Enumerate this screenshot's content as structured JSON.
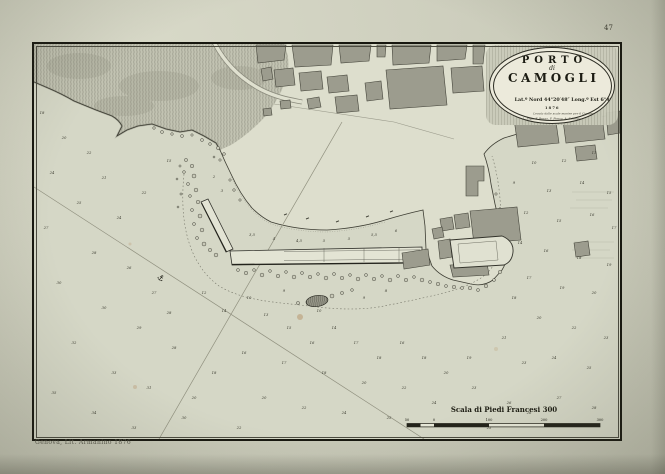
{
  "page": {
    "number": "47",
    "imprint": "Genova, Lit. Armanino 1876"
  },
  "cartouche": {
    "title_line1": "PORTO",
    "title_line2": "di",
    "title_line3": "CAMOGLI",
    "coords": "Lat.º Nord 44°20′48″ Long.º Est 6°49′5″",
    "year": "1876",
    "credit_line1": "Levata dalle scale marine per il Comune e di dettaglio di",
    "credit_line2": "L. Siga, F. Braga, F. Ponca, A. Schiavo"
  },
  "scale": {
    "title": "Scala di Piedi Francesi 300",
    "labels": [
      "50",
      "0",
      "100",
      "200",
      "300"
    ]
  },
  "map": {
    "anchor_symbol": "⚓",
    "soundings": [
      {
        "x": 8,
        "y": 70,
        "v": "18"
      },
      {
        "x": 30,
        "y": 95,
        "v": "20"
      },
      {
        "x": 55,
        "y": 110,
        "v": "22"
      },
      {
        "x": 18,
        "y": 130,
        "v": "24"
      },
      {
        "x": 70,
        "y": 135,
        "v": "21"
      },
      {
        "x": 45,
        "y": 160,
        "v": "25"
      },
      {
        "x": 12,
        "y": 185,
        "v": "27"
      },
      {
        "x": 85,
        "y": 175,
        "v": "24"
      },
      {
        "x": 110,
        "y": 150,
        "v": "22"
      },
      {
        "x": 135,
        "y": 118,
        "v": "15"
      },
      {
        "x": 60,
        "y": 210,
        "v": "28"
      },
      {
        "x": 95,
        "y": 225,
        "v": "26"
      },
      {
        "x": 25,
        "y": 240,
        "v": "30"
      },
      {
        "x": 120,
        "y": 250,
        "v": "27"
      },
      {
        "x": 70,
        "y": 265,
        "v": "30"
      },
      {
        "x": 105,
        "y": 285,
        "v": "29"
      },
      {
        "x": 40,
        "y": 300,
        "v": "32"
      },
      {
        "x": 140,
        "y": 305,
        "v": "28"
      },
      {
        "x": 80,
        "y": 330,
        "v": "33"
      },
      {
        "x": 20,
        "y": 350,
        "v": "35"
      },
      {
        "x": 115,
        "y": 345,
        "v": "31"
      },
      {
        "x": 60,
        "y": 370,
        "v": "34"
      },
      {
        "x": 150,
        "y": 375,
        "v": "30"
      },
      {
        "x": 100,
        "y": 385,
        "v": "33"
      },
      {
        "x": 135,
        "y": 270,
        "v": "28"
      },
      {
        "x": 180,
        "y": 134,
        "v": "2"
      },
      {
        "x": 188,
        "y": 148,
        "v": "3"
      },
      {
        "x": 240,
        "y": 196,
        "v": "4"
      },
      {
        "x": 265,
        "y": 198,
        "v": "4,5"
      },
      {
        "x": 290,
        "y": 198,
        "v": "5"
      },
      {
        "x": 315,
        "y": 196,
        "v": "5"
      },
      {
        "x": 340,
        "y": 192,
        "v": "5,5"
      },
      {
        "x": 362,
        "y": 188,
        "v": "6"
      },
      {
        "x": 218,
        "y": 192,
        "v": "3,5"
      },
      {
        "x": 170,
        "y": 250,
        "v": "12"
      },
      {
        "x": 190,
        "y": 268,
        "v": "14"
      },
      {
        "x": 215,
        "y": 255,
        "v": "10"
      },
      {
        "x": 232,
        "y": 272,
        "v": "13"
      },
      {
        "x": 255,
        "y": 285,
        "v": "15"
      },
      {
        "x": 278,
        "y": 300,
        "v": "16"
      },
      {
        "x": 300,
        "y": 285,
        "v": "14"
      },
      {
        "x": 322,
        "y": 300,
        "v": "17"
      },
      {
        "x": 345,
        "y": 315,
        "v": "18"
      },
      {
        "x": 368,
        "y": 300,
        "v": "16"
      },
      {
        "x": 390,
        "y": 315,
        "v": "18"
      },
      {
        "x": 412,
        "y": 330,
        "v": "20"
      },
      {
        "x": 435,
        "y": 315,
        "v": "19"
      },
      {
        "x": 370,
        "y": 345,
        "v": "22"
      },
      {
        "x": 330,
        "y": 340,
        "v": "20"
      },
      {
        "x": 290,
        "y": 330,
        "v": "18"
      },
      {
        "x": 250,
        "y": 320,
        "v": "17"
      },
      {
        "x": 210,
        "y": 310,
        "v": "16"
      },
      {
        "x": 180,
        "y": 330,
        "v": "18"
      },
      {
        "x": 230,
        "y": 355,
        "v": "20"
      },
      {
        "x": 270,
        "y": 365,
        "v": "22"
      },
      {
        "x": 310,
        "y": 370,
        "v": "24"
      },
      {
        "x": 355,
        "y": 375,
        "v": "25"
      },
      {
        "x": 400,
        "y": 360,
        "v": "24"
      },
      {
        "x": 440,
        "y": 345,
        "v": "23"
      },
      {
        "x": 475,
        "y": 360,
        "v": "26"
      },
      {
        "x": 205,
        "y": 385,
        "v": "22"
      },
      {
        "x": 160,
        "y": 355,
        "v": "20"
      },
      {
        "x": 250,
        "y": 248,
        "v": "9"
      },
      {
        "x": 285,
        "y": 268,
        "v": "10"
      },
      {
        "x": 330,
        "y": 255,
        "v": "9"
      },
      {
        "x": 352,
        "y": 248,
        "v": "8"
      },
      {
        "x": 500,
        "y": 120,
        "v": "10"
      },
      {
        "x": 530,
        "y": 118,
        "v": "12"
      },
      {
        "x": 560,
        "y": 110,
        "v": "11"
      },
      {
        "x": 480,
        "y": 140,
        "v": "9"
      },
      {
        "x": 515,
        "y": 148,
        "v": "13"
      },
      {
        "x": 548,
        "y": 140,
        "v": "14"
      },
      {
        "x": 575,
        "y": 150,
        "v": "15"
      },
      {
        "x": 492,
        "y": 170,
        "v": "12"
      },
      {
        "x": 525,
        "y": 178,
        "v": "15"
      },
      {
        "x": 558,
        "y": 172,
        "v": "16"
      },
      {
        "x": 580,
        "y": 185,
        "v": "17"
      },
      {
        "x": 486,
        "y": 200,
        "v": "14"
      },
      {
        "x": 512,
        "y": 208,
        "v": "16"
      },
      {
        "x": 545,
        "y": 215,
        "v": "18"
      },
      {
        "x": 575,
        "y": 222,
        "v": "19"
      },
      {
        "x": 495,
        "y": 235,
        "v": "17"
      },
      {
        "x": 528,
        "y": 245,
        "v": "19"
      },
      {
        "x": 560,
        "y": 250,
        "v": "20"
      },
      {
        "x": 505,
        "y": 275,
        "v": "20"
      },
      {
        "x": 540,
        "y": 285,
        "v": "22"
      },
      {
        "x": 572,
        "y": 295,
        "v": "23"
      },
      {
        "x": 520,
        "y": 315,
        "v": "24"
      },
      {
        "x": 555,
        "y": 325,
        "v": "25"
      },
      {
        "x": 490,
        "y": 320,
        "v": "23"
      },
      {
        "x": 470,
        "y": 295,
        "v": "21"
      },
      {
        "x": 480,
        "y": 255,
        "v": "18"
      },
      {
        "x": 525,
        "y": 355,
        "v": "27"
      },
      {
        "x": 560,
        "y": 365,
        "v": "28"
      },
      {
        "x": 495,
        "y": 370,
        "v": "26"
      },
      {
        "x": 455,
        "y": 385,
        "v": "25"
      }
    ]
  }
}
